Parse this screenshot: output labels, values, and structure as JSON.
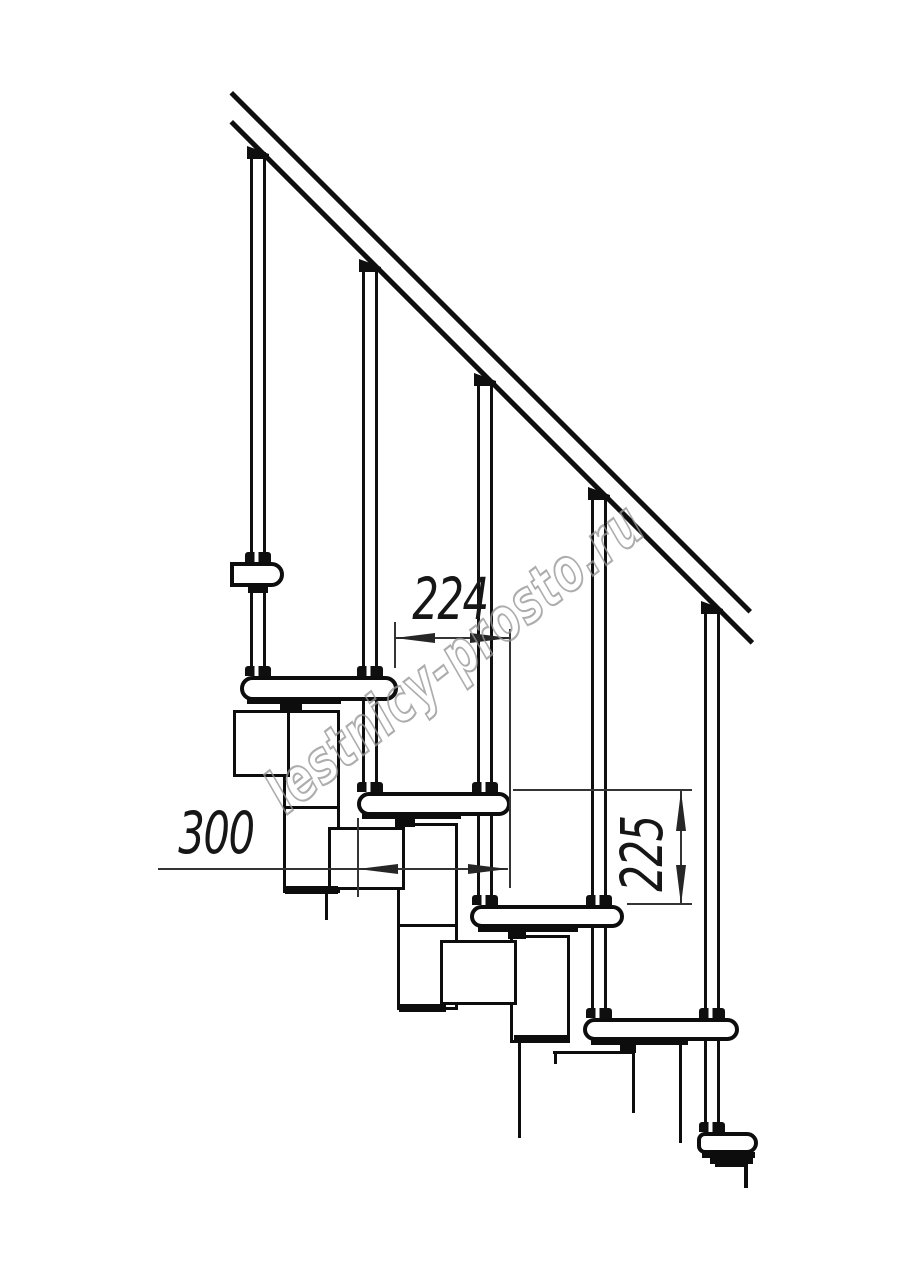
{
  "drawing": {
    "kind": "modular-staircase-side-view",
    "watermark": {
      "text": "lestnicy-prosto.ru"
    },
    "dims": {
      "d224": {
        "value": "224",
        "orientation": "horizontal"
      },
      "d300": {
        "value": "300",
        "orientation": "horizontal"
      },
      "d225": {
        "value": "225",
        "orientation": "vertical"
      }
    },
    "counts": {
      "balusters": 5,
      "treads": 5
    },
    "colors": {
      "line": "#0f0f0f",
      "thin_line": "#343434",
      "watermark_stroke": "#969696",
      "background": "#ffffff"
    }
  }
}
